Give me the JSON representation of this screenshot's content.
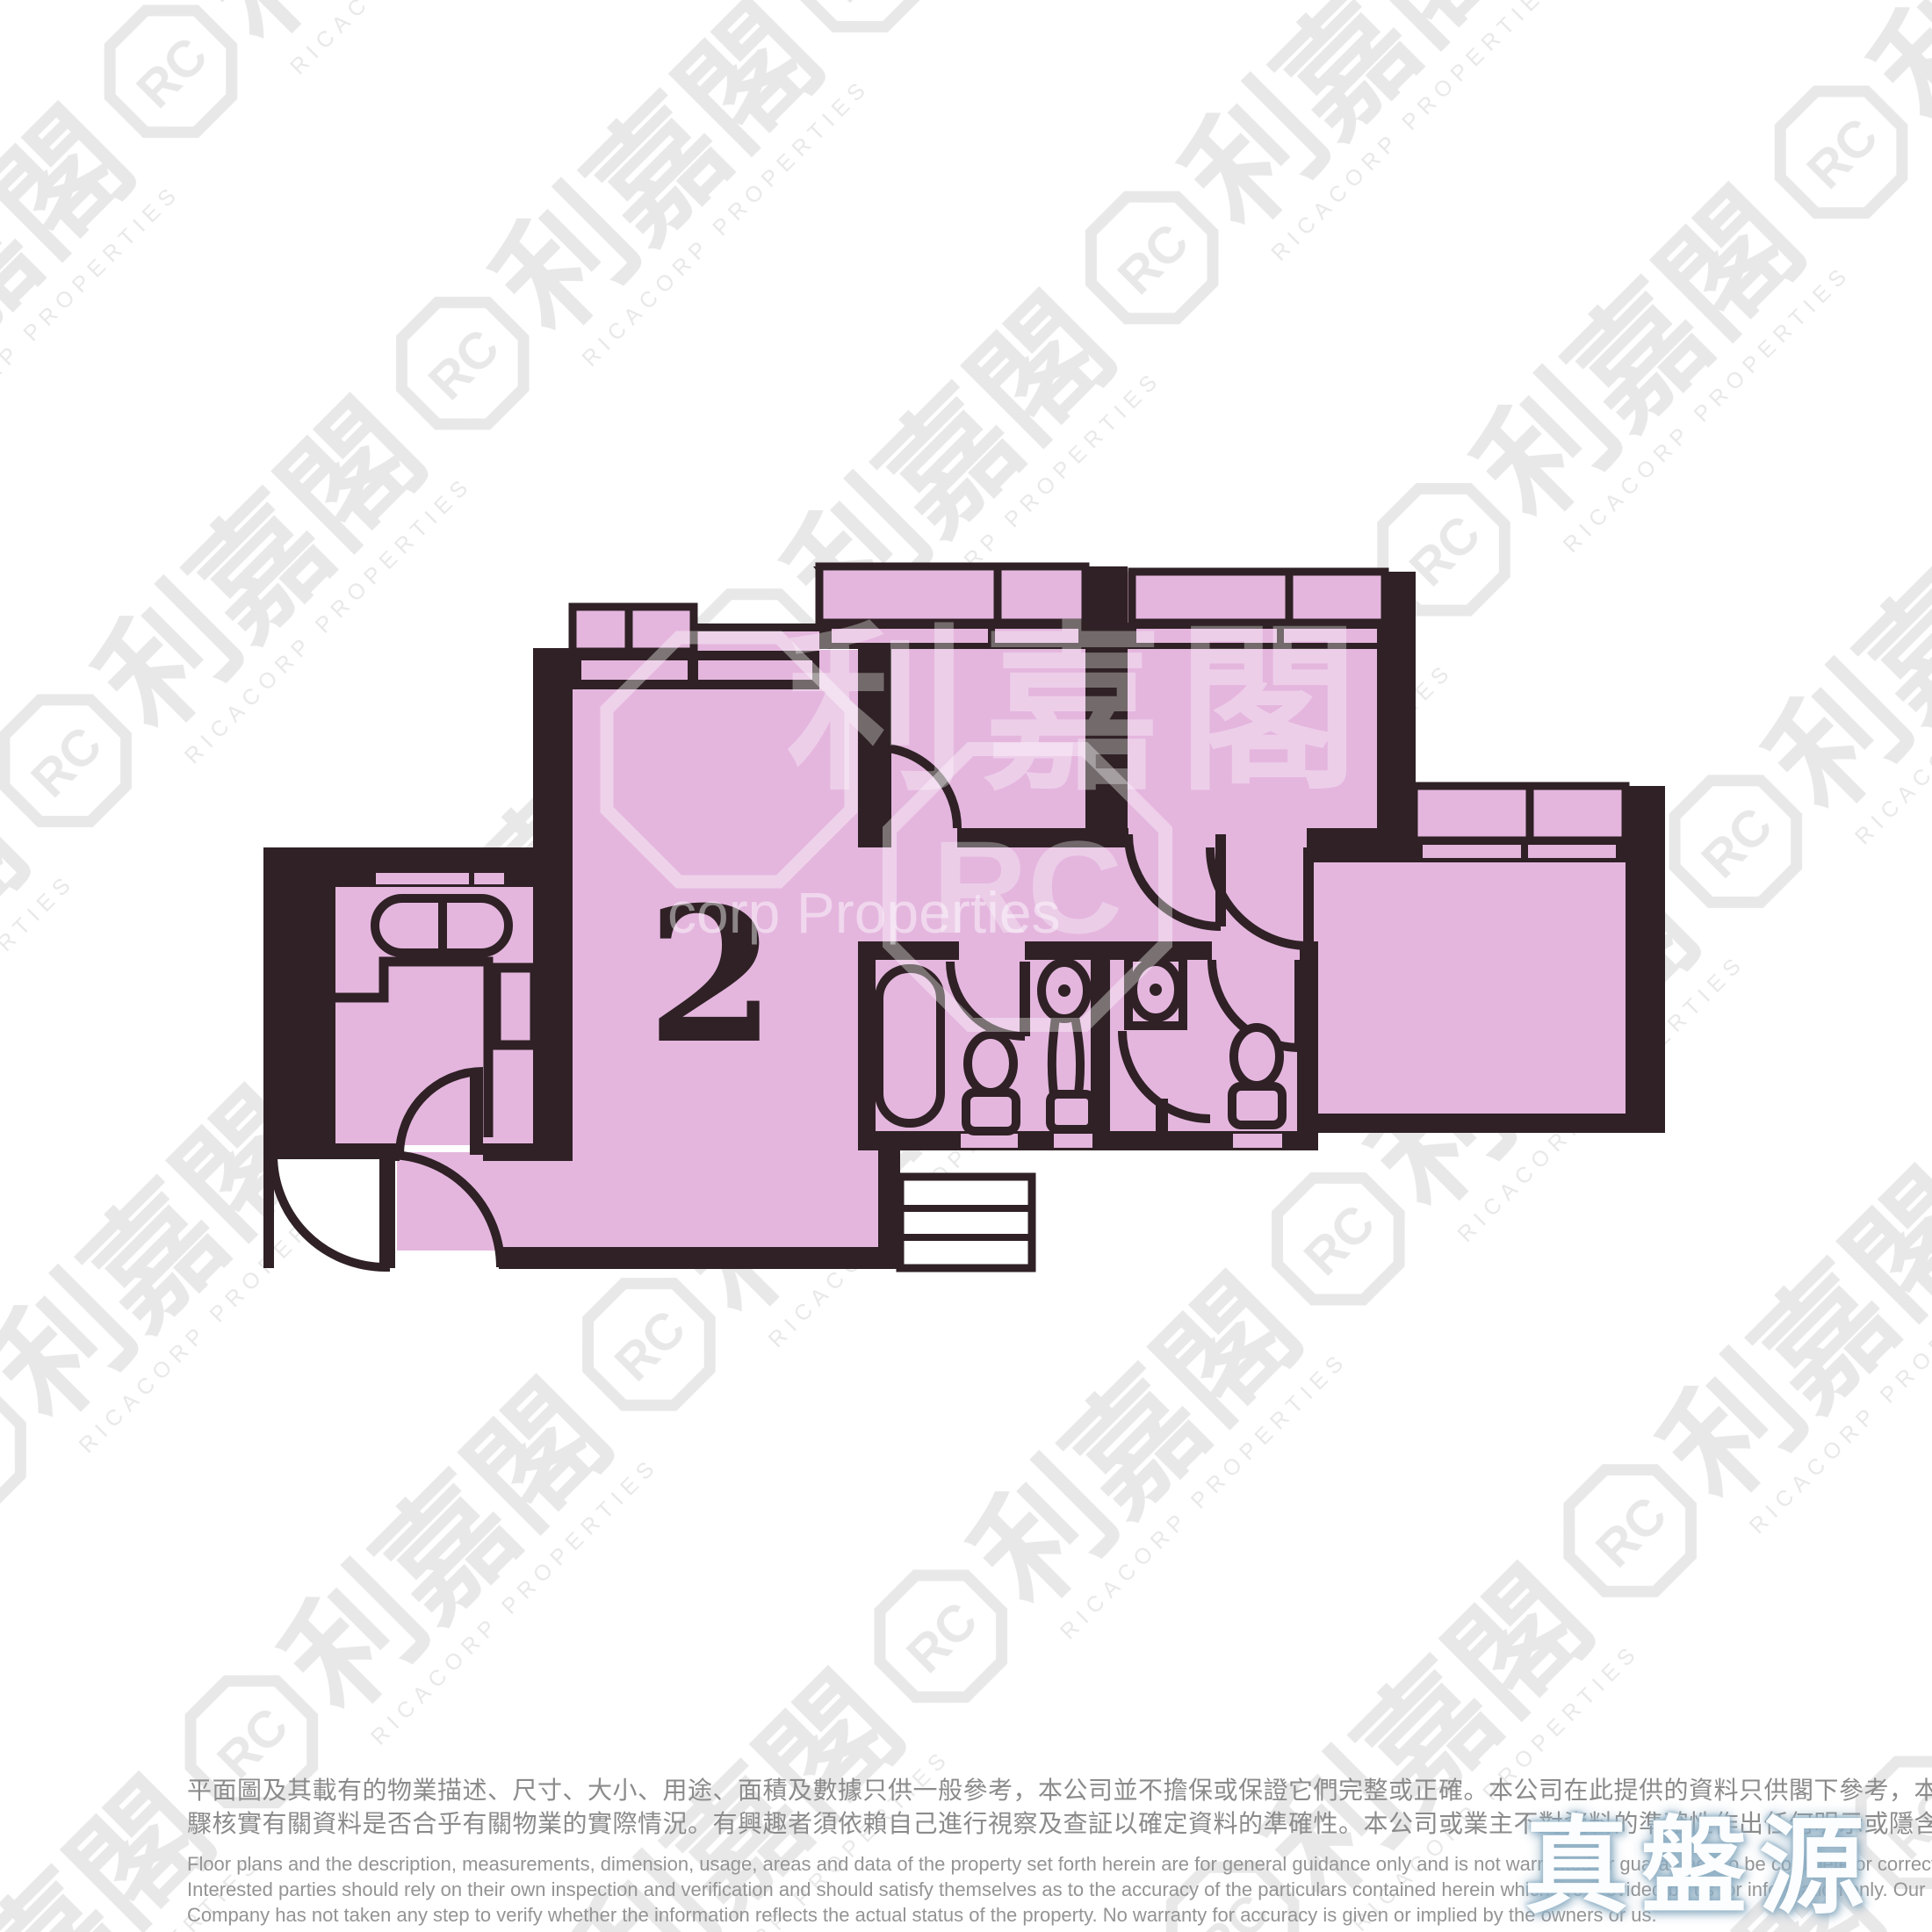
{
  "floor_plan": {
    "unit_label": "2",
    "room_fill": "#e4b6de",
    "wall_color": "#2f2125"
  },
  "watermark": {
    "brand_zh": "利嘉閣",
    "brand_en_caps": "RICACORP PROPERTIES",
    "logo_monogram": "RC",
    "center_fragment": "corp Properties",
    "tile_color": "#e8e8e8"
  },
  "badge": {
    "text": "真盤源"
  },
  "disclaimer": {
    "zh_lines": [
      "平面圖及其載有的物業描述、尺寸、大小、用途、面積及數據只供一般參考，本公司並不擔保或保證它們完整或正確。本公司在此提供的資料只供閣下參考，本公司並無採取任何步",
      "驟核實有關資料是否合乎有關物業的實際情況。有興趣者須依賴自己進行視察及查証以確定資料的準確性。本公司或業主不對資料的準確性作出任何明示或隱含的保證。"
    ],
    "en_lines": [
      "Floor plans and the description, measurements, dimension, usage, areas and data of the property set forth herein are for general guidance only and is not warranted or guaranteed to be complete or correct.",
      "Interested parties should rely on their own inspection and verification and should satisfy themselves as to the accuracy of the particulars contained herein which are provided by us for information only.  Our",
      "Company has not taken any step to verify whether the information reflects the actual status of the property.  No warranty for accuracy is given or implied by the owners or us."
    ]
  }
}
